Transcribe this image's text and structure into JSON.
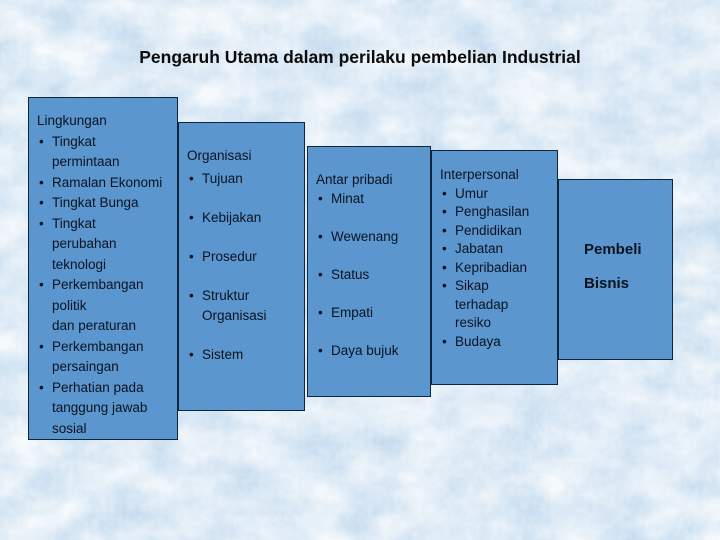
{
  "title": "Pengaruh Utama dalam perilaku pembelian Industrial",
  "colors": {
    "background": "#c5dcef",
    "box_fill": "#5b96ce",
    "box_border": "#10253c",
    "box_text": "#0a1322",
    "title_text": "#0b0b0b"
  },
  "boxes": [
    {
      "header": "Lingkungan",
      "items": [
        {
          "lines": [
            "Tingkat",
            "permintaan"
          ]
        },
        {
          "lines": [
            "Ramalan Ekonomi"
          ]
        },
        {
          "lines": [
            "Tingkat Bunga"
          ]
        },
        {
          "lines": [
            "Tingkat",
            "perubahan",
            "teknologi"
          ]
        },
        {
          "lines": [
            "Perkembangan",
            "politik",
            "dan peraturan"
          ]
        },
        {
          "lines": [
            "Perkembangan",
            "persaingan"
          ]
        },
        {
          "lines": [
            "Perhatian pada",
            "tanggung jawab",
            "sosial"
          ]
        }
      ]
    },
    {
      "header": "Organisasi",
      "items": [
        {
          "lines": [
            "Tujuan"
          ]
        },
        {
          "lines": [
            "Kebijakan"
          ]
        },
        {
          "lines": [
            "Prosedur"
          ]
        },
        {
          "lines": [
            "Struktur",
            "Organisasi"
          ]
        },
        {
          "lines": [
            "Sistem"
          ]
        }
      ]
    },
    {
      "header": "Antar pribadi",
      "items": [
        {
          "lines": [
            "Minat"
          ]
        },
        {
          "lines": [
            "Wewenang"
          ]
        },
        {
          "lines": [
            "Status"
          ]
        },
        {
          "lines": [
            "Empati"
          ]
        },
        {
          "lines": [
            "Daya bujuk"
          ]
        }
      ]
    },
    {
      "header": "Interpersonal",
      "items": [
        {
          "lines": [
            "Umur"
          ]
        },
        {
          "lines": [
            "Penghasilan"
          ]
        },
        {
          "lines": [
            "Pendidikan"
          ]
        },
        {
          "lines": [
            "Jabatan"
          ]
        },
        {
          "lines": [
            "Kepribadian"
          ]
        },
        {
          "lines": [
            "Sikap",
            "terhadap",
            "resiko"
          ]
        },
        {
          "lines": [
            "Budaya"
          ]
        }
      ]
    },
    {
      "lines": [
        "Pembeli",
        "Bisnis"
      ]
    }
  ]
}
